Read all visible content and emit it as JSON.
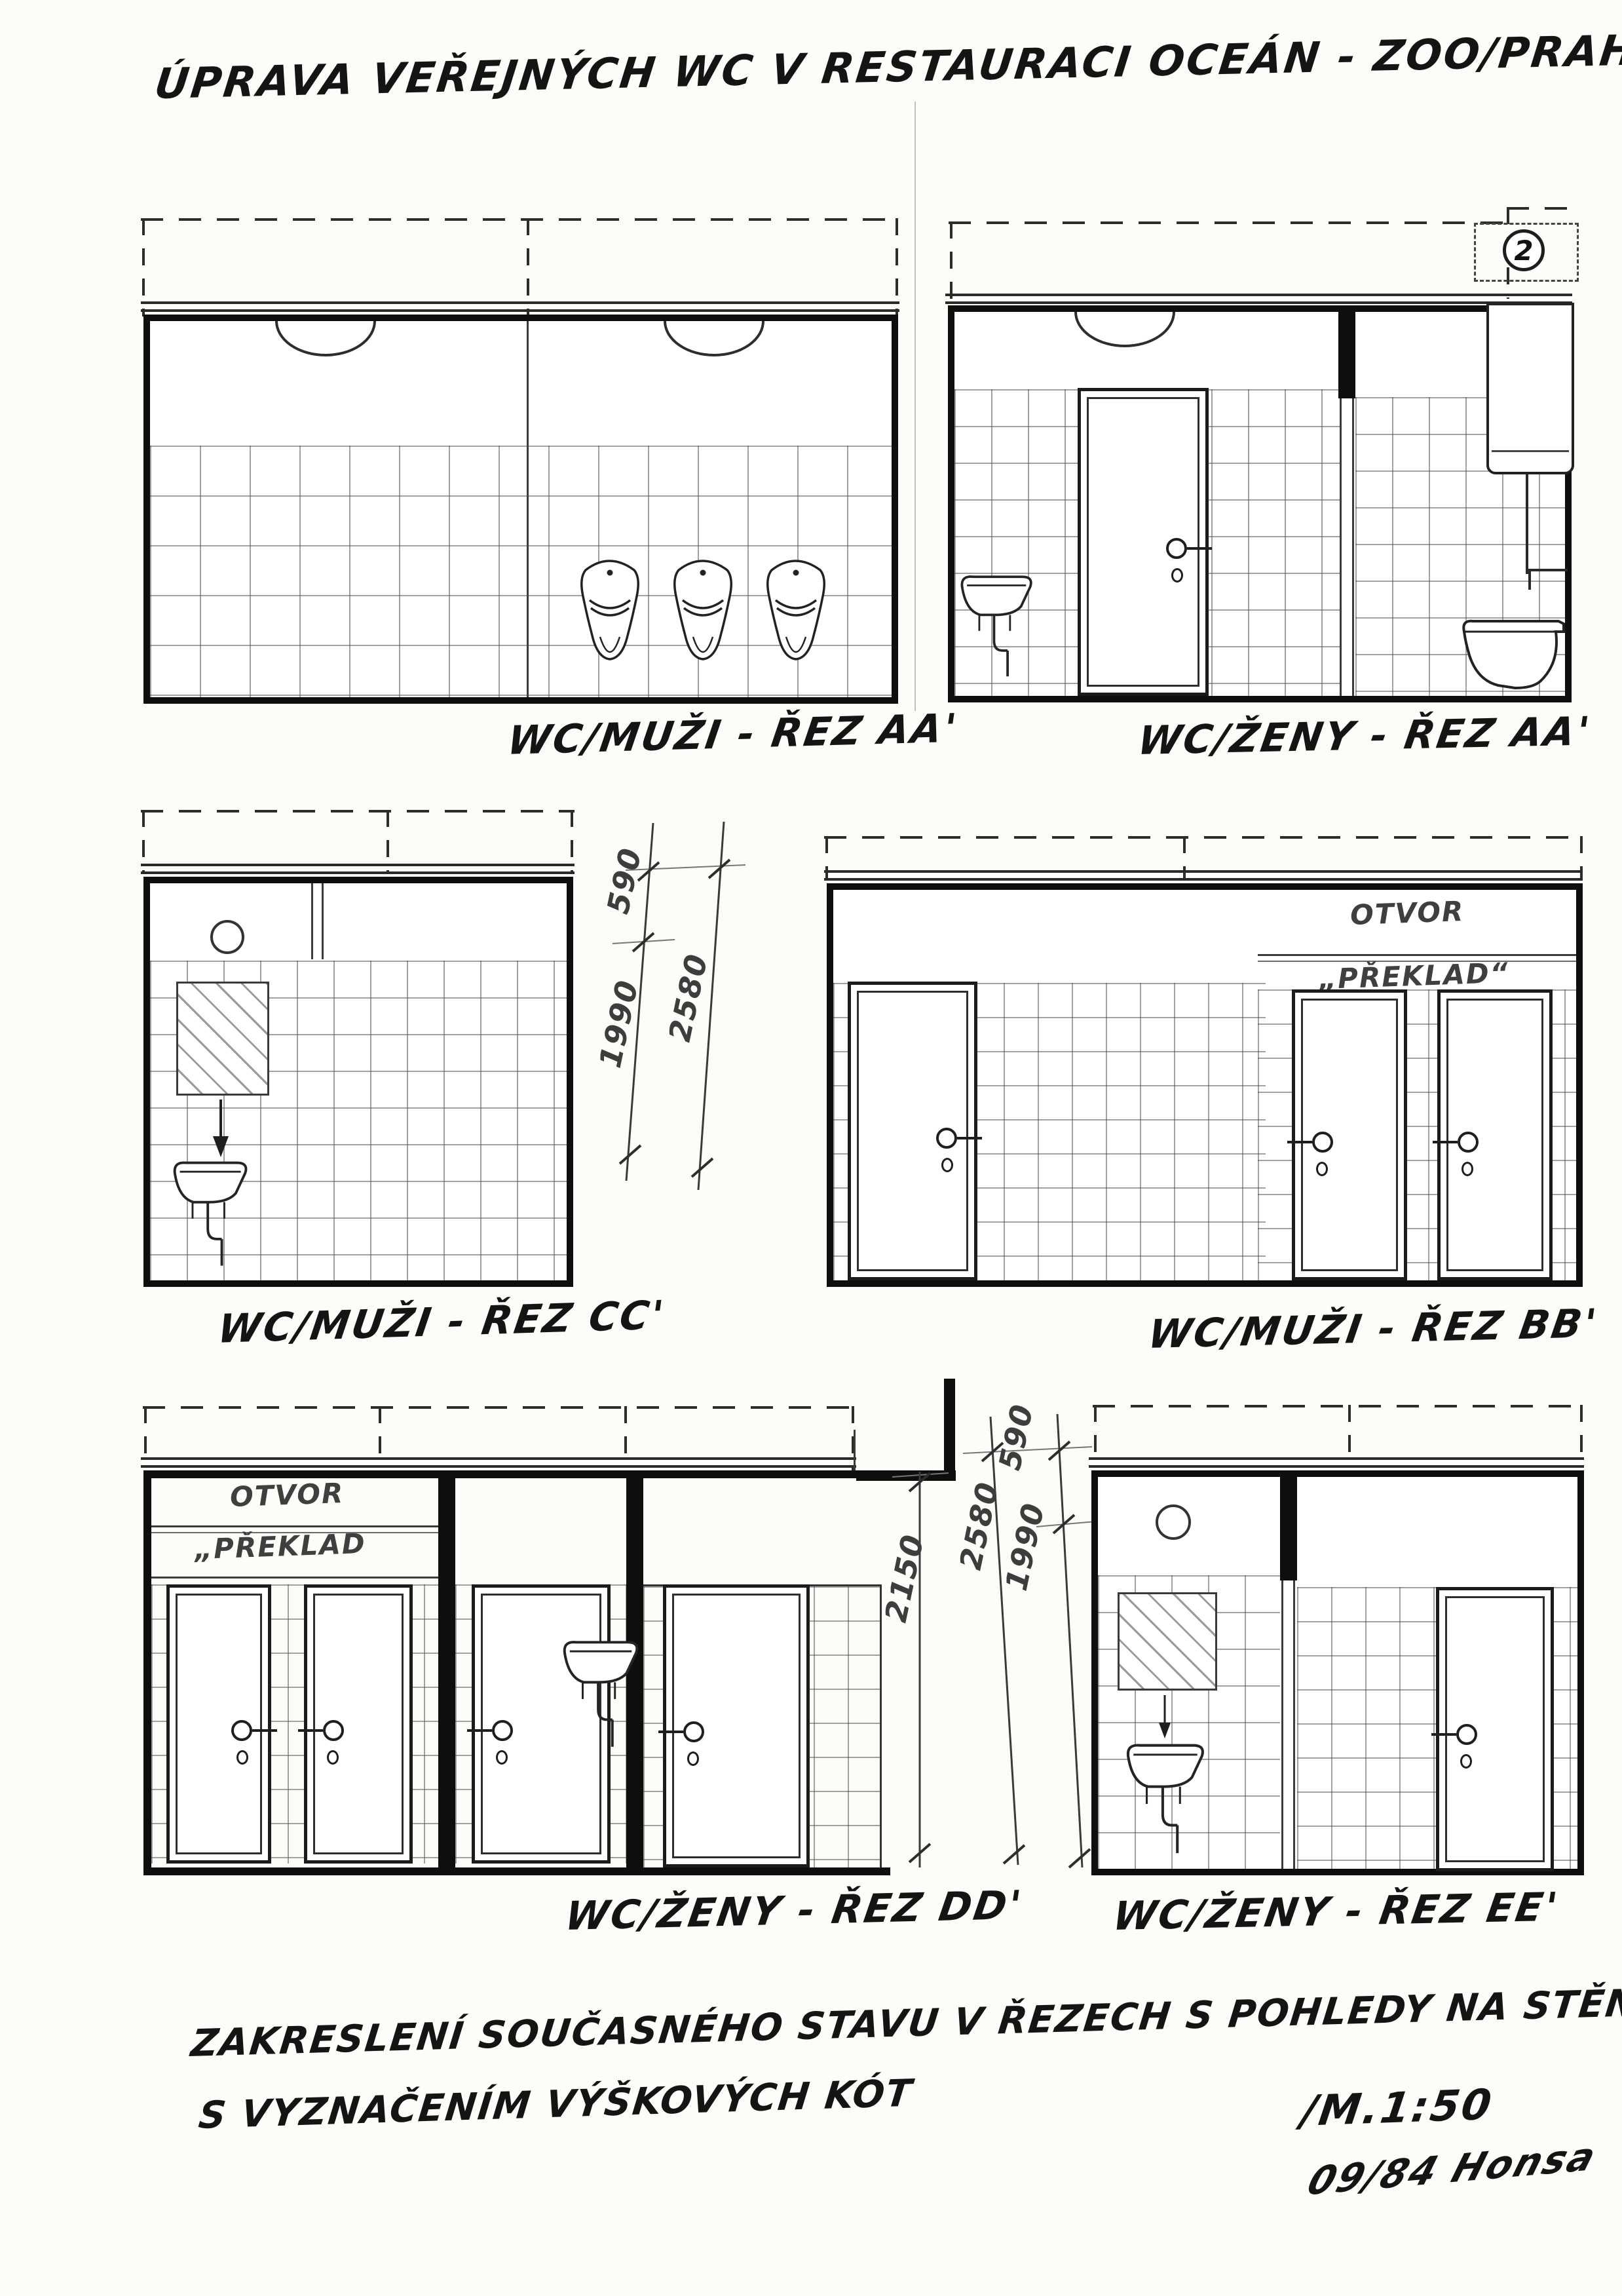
{
  "page": {
    "number": "2"
  },
  "title": "ÚPRAVA VEŘEJNÝCH WC V RESTAURACI OCEÁN - ZOO/PRAHA",
  "drawings": {
    "men_aa": {
      "caption": "WC/MUŽI - ŘEZ AA'"
    },
    "women_aa": {
      "caption": "WC/ŽENY - ŘEZ AA'"
    },
    "men_cc": {
      "caption": "WC/MUŽI - ŘEZ CC'"
    },
    "men_bb": {
      "caption": "WC/MUŽI - ŘEZ BB'",
      "otvor": "OTVOR",
      "preklad": "„PŘEKLAD“"
    },
    "women_dd": {
      "caption": "WC/ŽENY - ŘEZ DD'",
      "otvor": "OTVOR",
      "preklad": "„PŘEKLAD"
    },
    "women_ee": {
      "caption": "WC/ŽENY - ŘEZ EE'"
    }
  },
  "dims": {
    "row2": {
      "d590": "590",
      "d1990": "1990",
      "d2580": "2580"
    },
    "row3": {
      "d2150": "2150",
      "d2580": "2580",
      "d1990": "1990",
      "d590": "590"
    }
  },
  "footer": {
    "note_line1": "ZAKRESLENÍ SOUČASNÉHO STAVU V ŘEZECH S POHLEDY NA STĚNY",
    "note_line2": "S VYZNAČENÍM VÝŠKOVÝCH KÓT",
    "scale": "/M.1:50",
    "signature": "09/84 Honsa"
  },
  "colors": {
    "paper": "#fcfcf9",
    "ink": "#141414",
    "pencil": "#3f3f3f"
  }
}
